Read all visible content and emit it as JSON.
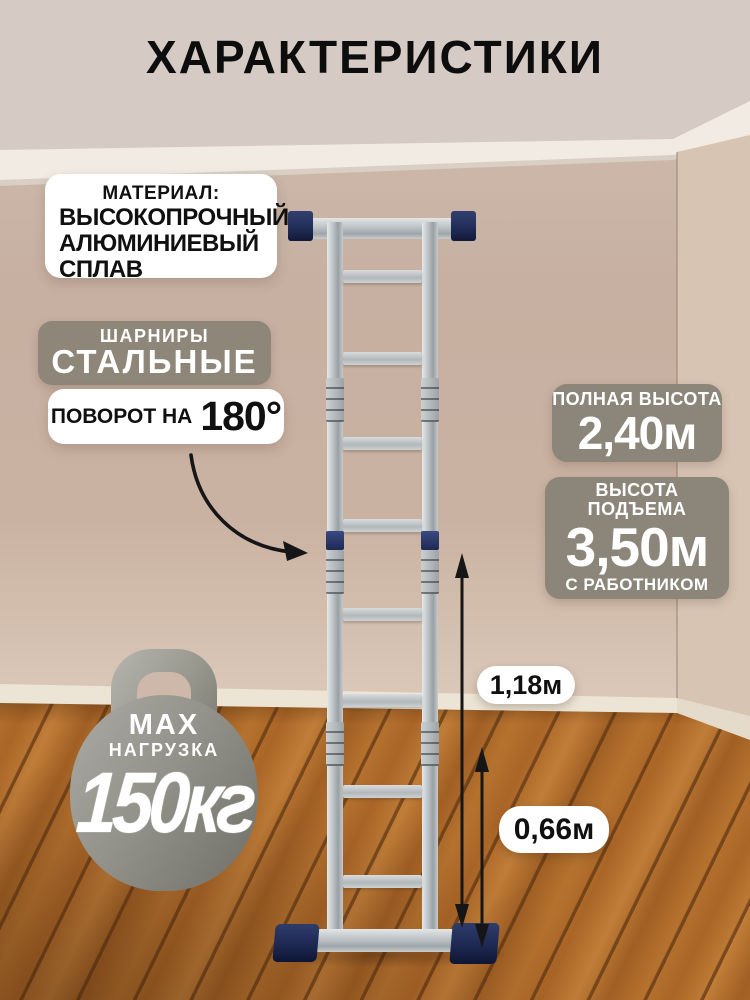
{
  "title": "ХАРАКТЕРИСТИКИ",
  "material_box": {
    "label": "МАТЕРИАЛ:",
    "lines": [
      "ВЫСОКОПРОЧНЫЙ",
      "АЛЮМИНИЕВЫЙ",
      "СПЛАВ"
    ]
  },
  "hinge_box": {
    "top": "ШАРНИРЫ",
    "main": "СТАЛЬНЫЕ"
  },
  "rotation_box": {
    "prefix": "ПОВОРОТ НА",
    "value": "180°"
  },
  "load_badge": {
    "line1": "MAX",
    "line2": "НАГРУЗКА",
    "value": "150кг"
  },
  "height_badges": [
    {
      "label": "ПОЛНАЯ ВЫСОТА",
      "value": "2,40м"
    },
    {
      "label": "ВЫСОТА ПОДЪЕМА",
      "value": "3,50м",
      "note": "С РАБОТНИКОМ"
    }
  ],
  "measurements": [
    {
      "value": "1,18м"
    },
    {
      "value": "0,66м"
    }
  ],
  "colors": {
    "wall": "#c9b3a4",
    "ceiling": "#d5cbc4",
    "molding": "#f1ebe3",
    "floor_wood": "#b5722f",
    "badge_gray": "#8c867a",
    "ladder_caps_navy": "#26335f",
    "text_black": "#0d0d0d",
    "text_white": "#ffffff"
  }
}
